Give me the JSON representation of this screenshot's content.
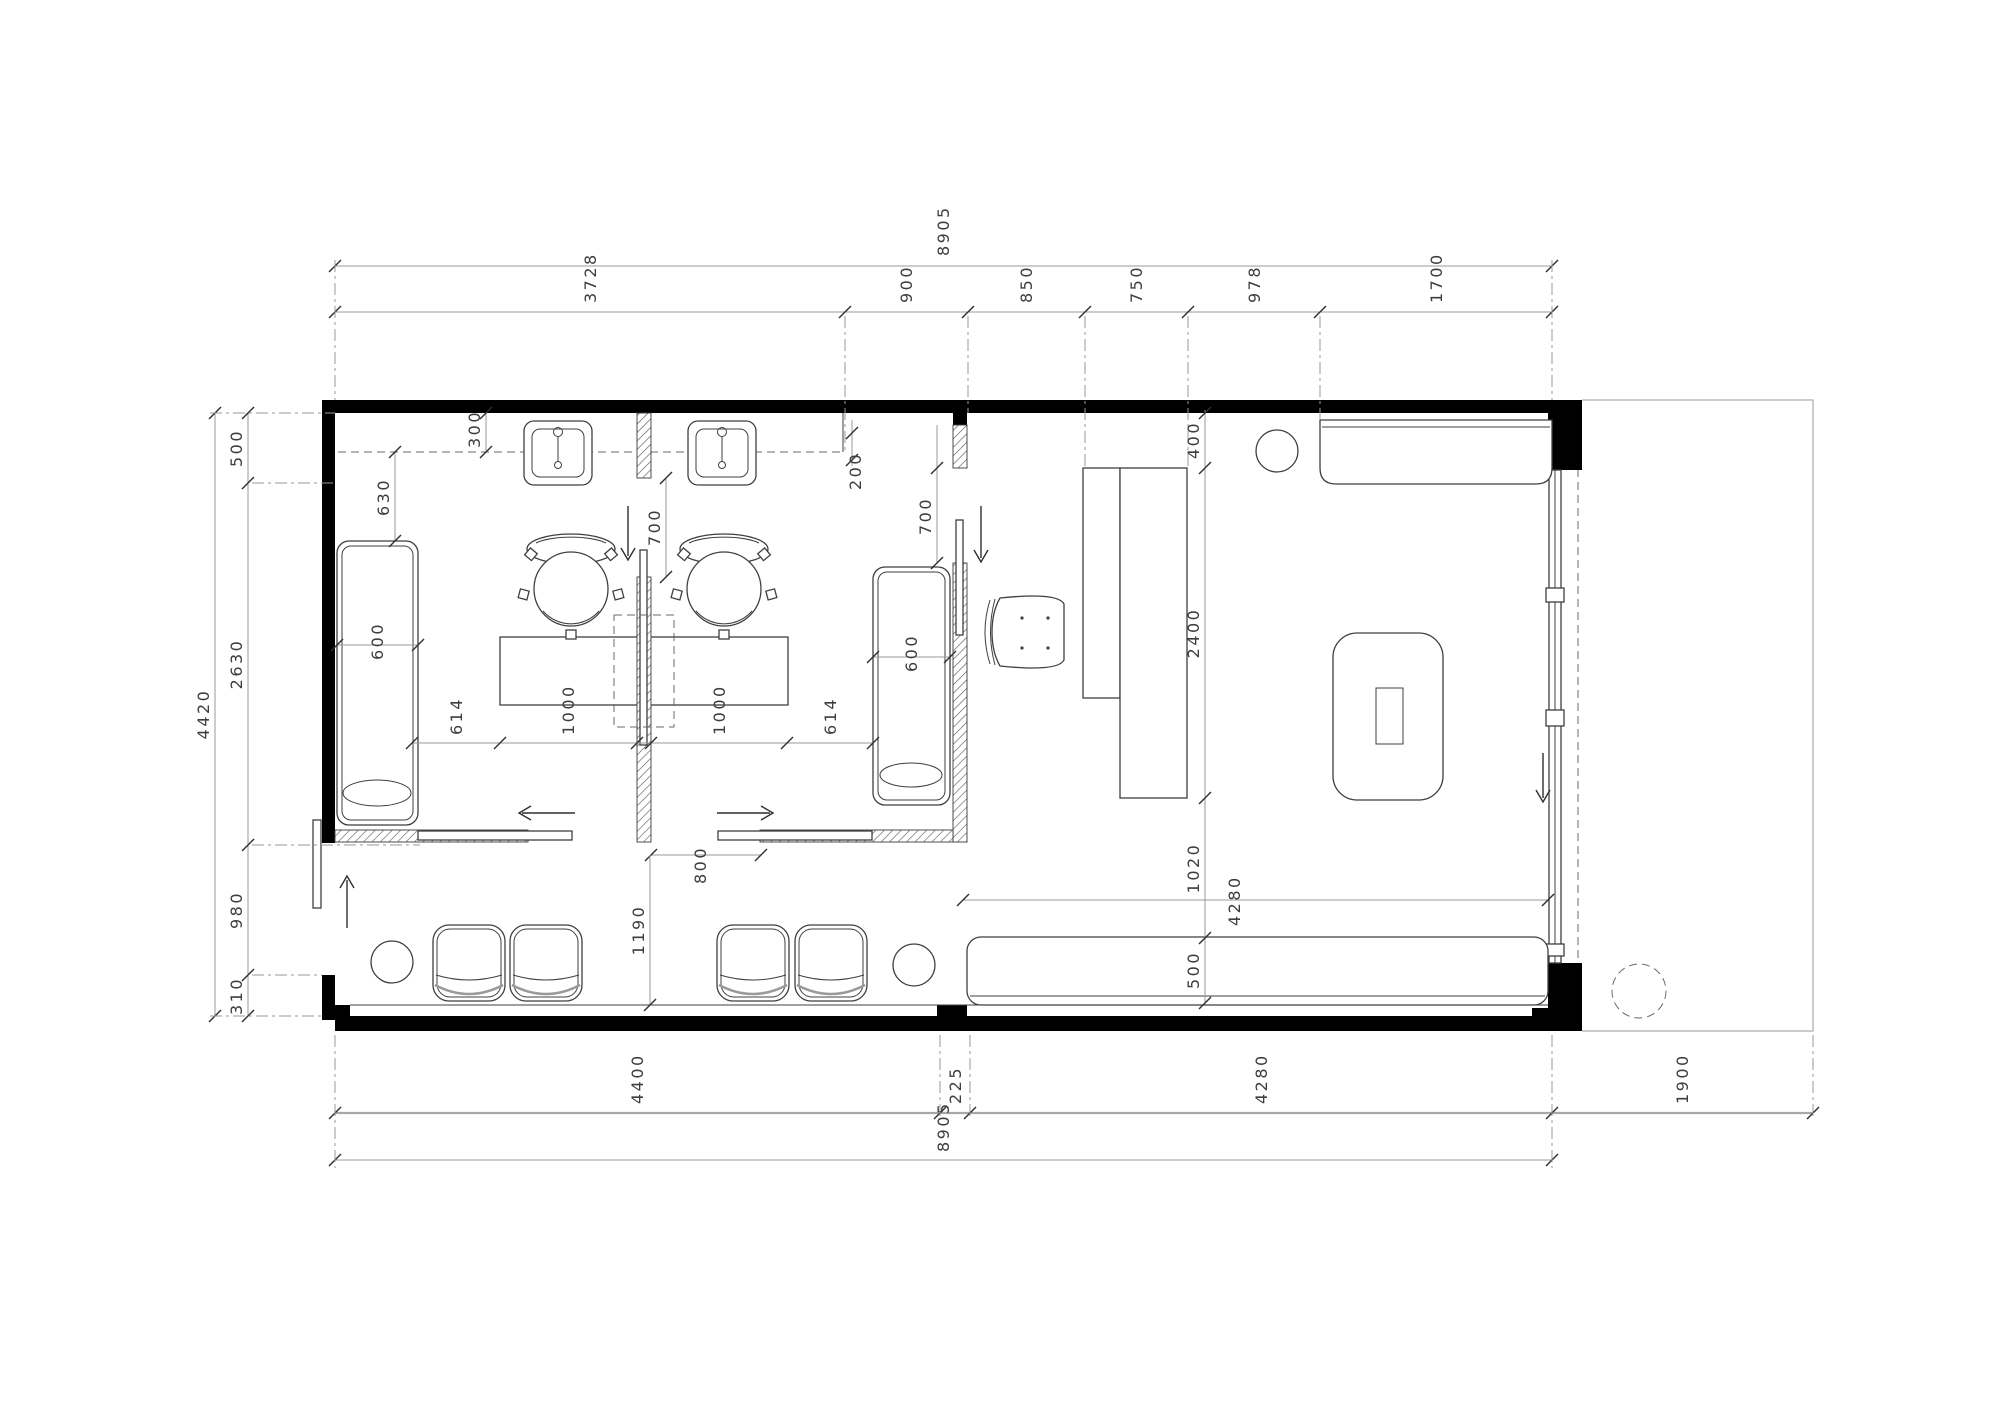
{
  "drawing": {
    "type": "architectural-floor-plan",
    "units": "mm"
  },
  "colors": {
    "wall": "#000000",
    "furniture_line": "#3f3f3f",
    "dimension_line": "#9a9a9a",
    "dimension_text": "#3d3d3d",
    "hatch": "#555555"
  },
  "dimensions": {
    "top": {
      "overall": "8905",
      "segments": [
        "3728",
        "900",
        "850",
        "750",
        "978",
        "1700"
      ]
    },
    "left": {
      "overall": "4420",
      "segments": [
        "500",
        "2630",
        "980",
        "310"
      ]
    },
    "bottom": {
      "overall": "8905",
      "segments": [
        "4400",
        "225",
        "4280"
      ],
      "outside": "1900"
    },
    "interior": {
      "counter_depth": "300",
      "counter_end": "200",
      "lounger_offset": "630",
      "lounger1_width": "600",
      "lounger2_width": "600",
      "door1_opening": "700",
      "door2_opening": "700",
      "room_row": [
        "614",
        "1000",
        "1000",
        "614"
      ],
      "slide_opening": "800",
      "corridor": "1190",
      "right_chain": [
        "400",
        "2400",
        "1020",
        "500"
      ],
      "bench_length": "4280"
    }
  }
}
